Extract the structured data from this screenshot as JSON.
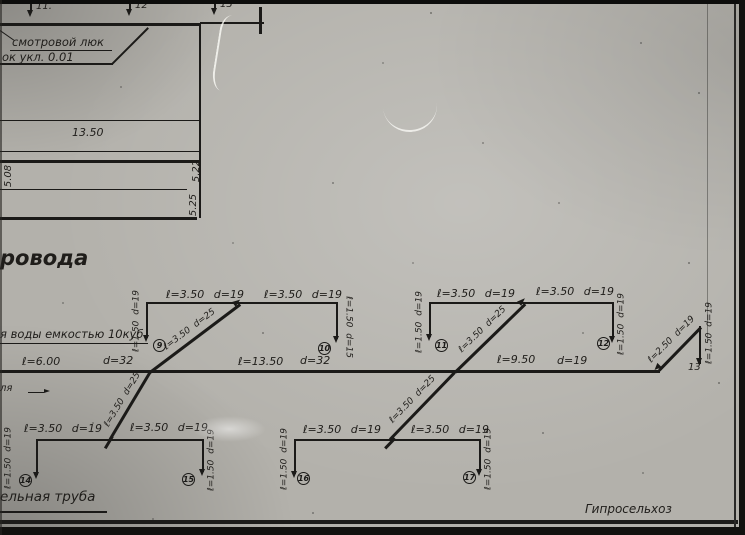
{
  "drawing": {
    "plan": {
      "marker1": "11.",
      "marker2": "12",
      "marker3": "13",
      "callout_line1": "смотровой люк",
      "callout_line2": "ок укл. 0.01",
      "dim_width": "13.50",
      "dim_left": "5.08",
      "dim_right_upper": "5.22",
      "dim_right_lower": "5.25"
    },
    "title_fragment": "ровода",
    "tank_note": "я воды емкостью 10куб",
    "ground_note": "ля",
    "pipe_note": "ельная труба",
    "org": "Гипросельхоз",
    "main": {
      "seg1_len": "ℓ=6.00",
      "seg1_dia": "d=32",
      "seg2_len": "ℓ=13.50",
      "seg2_dia": "d=32",
      "seg3_len": "ℓ=9.50",
      "seg3_dia": "d=19",
      "end_diag": "ℓ=2.50 d=19",
      "end_riser": "ℓ=1.50 d=19",
      "end_node": "13"
    },
    "branchA": {
      "top_left": "ℓ=3.50 d=19",
      "top_right": "ℓ=3.50 d=19",
      "riser_left": "ℓ=1.50 d=19",
      "riser_right": "ℓ=1.50 d=15",
      "node_left": "9",
      "node_right": "10",
      "diag_upper": "ℓ=3.50 d=25",
      "diag_lower": "ℓ=3.50 d=25"
    },
    "branchB": {
      "top_left": "ℓ=3.50 d=19",
      "top_right": "ℓ=3.50 d=19",
      "riser_left": "ℓ=1.50 d=19",
      "riser_right": "ℓ=1.50 d=19",
      "node_left": "11",
      "node_right": "12",
      "diag_upper": "ℓ=3.50 d=25",
      "diag_lower": "ℓ=3.50 d=25"
    },
    "branchC": {
      "top_left": "ℓ=3.50 d=19",
      "top_right": "ℓ=3.50 d=19",
      "riser_left": "ℓ=1.50 d=19",
      "riser_right": "ℓ=1.50 d=19",
      "node_left": "14",
      "node_right": "15"
    },
    "branchD": {
      "top_left": "ℓ=3.50 d=19",
      "top_right": "ℓ=3.50 d=19",
      "riser_left": "ℓ=1.50 d=19",
      "riser_right": "ℓ=1.50 d=19",
      "node_left": "16",
      "node_right": "17"
    },
    "ink_color": "#1b1a18",
    "paper_color": "#b3b1ab"
  }
}
